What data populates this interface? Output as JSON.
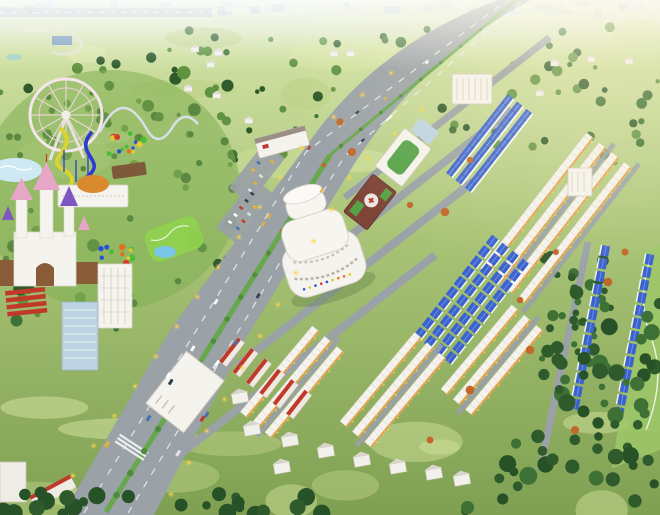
{
  "scene": {
    "name": "aerial-3d-masterplan-render",
    "setting": "planned-township-with-amusement-park",
    "landmarks": [
      "ferris-wheel",
      "roller-coaster",
      "water-slides",
      "wave-pool",
      "playground",
      "fairy-castle",
      "dome-hotel",
      "carousel",
      "mini-golf-course",
      "swimming-pool",
      "garden-pavilion",
      "red-roof-rowhouses",
      "white-residential-tower",
      "glass-residential-tower",
      "parking-lot",
      "school-building",
      "shopping-mall",
      "hospital-building",
      "sports-hall",
      "condo-building",
      "office-slab",
      "warehouse-row",
      "industrial-building",
      "main-boulevard",
      "distant-town",
      "forest",
      "farmland",
      "shophouse-rows",
      "blue-villa-rows",
      "villa-column"
    ]
  },
  "palette": {
    "sky": "#e9f2ee",
    "town": "#c2d2e0",
    "fieldLight": "#cfe09a",
    "fieldMid": "#abc578",
    "grass": "#8fba5e",
    "parkGrass": "#7fae52",
    "treeDark": "#2e5a2c",
    "treeMid": "#3e7136",
    "treeLight": "#5f9340",
    "autumn": "#c2672a",
    "road": "#9aa1a7",
    "roadDark": "#878e94",
    "lane": "#eceef0",
    "median": "#67a84c",
    "white": "#f5f3ee",
    "shade": "#d9d4ca",
    "eaveOrange": "#e59b3c",
    "roofRed": "#c0392b",
    "roofBlue": "#3a63cf",
    "roofBlueDark": "#2a4ba8",
    "castlePink": "#e7a6c7",
    "castlePurple": "#7e57c2",
    "castleBrown": "#8a5b37",
    "dome": "#d98a2e",
    "slideYellow": "#ddd32f",
    "slideBlue": "#2d39d6",
    "minigolf": "#8fd14f",
    "water": "#79c6e8",
    "brick": "#7e4437",
    "roofGreen": "#55a247",
    "glass": "#bdd3e3",
    "glow": "#ffd34d",
    "sun": "#fff3cf",
    "pavilion": "#7e5a3a",
    "cars": [
      "#ffffff",
      "#dfe3e7",
      "#c0392b",
      "#2c3e50",
      "#e8b23a",
      "#4a6fb0",
      "#9aa39f"
    ],
    "play": [
      "#d43b2a",
      "#2b50d4",
      "#e6c92f",
      "#49bd36",
      "#e2701f"
    ]
  },
  "scatter": {
    "distantBuildings": 36,
    "fieldPatches": 24,
    "topTrees": 95,
    "tentHouses": 22,
    "parkTrees": 80,
    "medianTrees": 24,
    "vehicles": 26,
    "streetLights": 30,
    "parkingCars": 20,
    "forestTrees": 175,
    "midForest": 40,
    "bottomTrees": 26
  },
  "estate": {
    "blocks": [
      {
        "name": "terraced-houses-blue",
        "type": "terrace",
        "cx": 489,
        "cy": 143,
        "rot": -52,
        "rows": 3,
        "len": 100,
        "gap": 12
      },
      {
        "name": "shophouse-rows-upper",
        "type": "shop",
        "cx": 556,
        "cy": 218,
        "rot": -52,
        "rows": 4,
        "len": 172,
        "gap": 16
      },
      {
        "name": "blue-villa-rows",
        "type": "bluevilla",
        "cx": 474,
        "cy": 296,
        "rot": -52,
        "rows": 4,
        "len": 140,
        "gap": 13
      },
      {
        "name": "shophouse-block-a",
        "type": "shop",
        "cx": 292,
        "cy": 382,
        "rot": -50,
        "rows": 3,
        "len": 112,
        "gap": 16
      },
      {
        "name": "shophouse-block-b",
        "type": "shop",
        "cx": 393,
        "cy": 390,
        "rot": -50,
        "rows": 3,
        "len": 116,
        "gap": 16
      },
      {
        "name": "shophouse-block-c",
        "type": "shop",
        "cx": 492,
        "cy": 360,
        "rot": -50,
        "rows": 3,
        "len": 110,
        "gap": 16
      },
      {
        "name": "villa-column-right",
        "type": "bluevilla",
        "cx": 612,
        "cy": 334,
        "rot": 101,
        "rows": 2,
        "len": 175,
        "gap": 45
      }
    ]
  },
  "southVillas": [
    [
      252,
      430
    ],
    [
      290,
      441
    ],
    [
      326,
      452
    ],
    [
      362,
      461
    ],
    [
      398,
      468
    ],
    [
      434,
      474
    ],
    [
      282,
      468
    ],
    [
      462,
      480
    ],
    [
      240,
      398
    ]
  ],
  "accentTrees": [
    [
      340,
      122
    ],
    [
      352,
      152
    ],
    [
      302,
      212
    ],
    [
      445,
      212
    ],
    [
      520,
      300
    ],
    [
      556,
      252
    ],
    [
      608,
      282
    ],
    [
      530,
      350
    ],
    [
      470,
      390
    ],
    [
      430,
      440
    ],
    [
      575,
      430
    ],
    [
      625,
      252
    ],
    [
      410,
      205
    ],
    [
      470,
      160
    ]
  ]
}
